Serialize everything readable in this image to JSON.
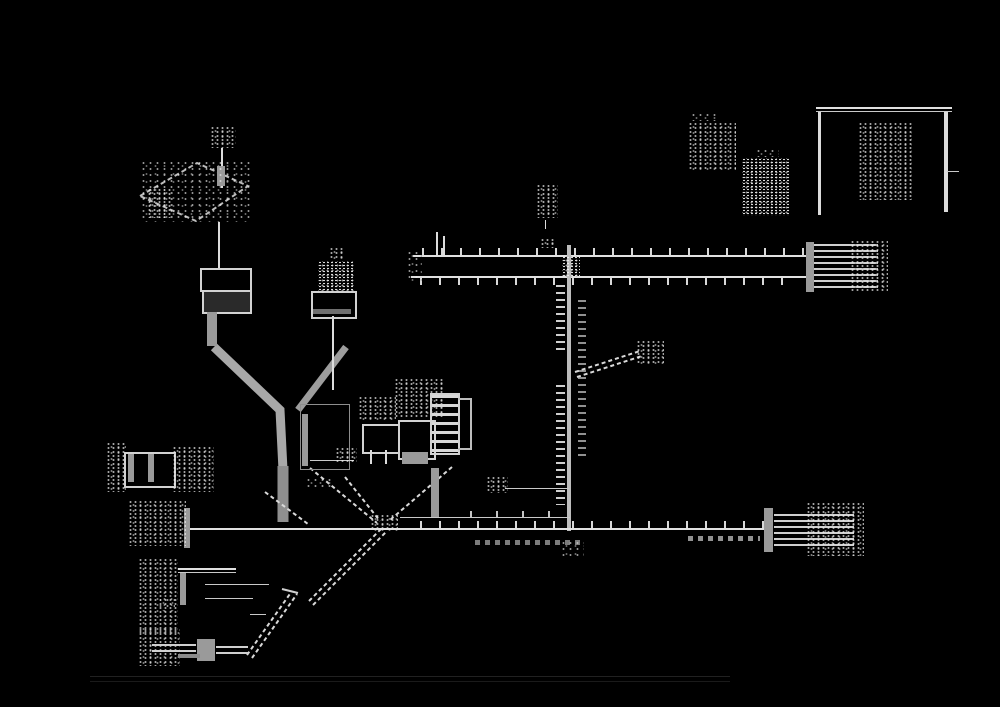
{
  "diagram": {
    "description": "Inverted black-background scan of a vehicle wiring-harness routing diagram; all callout labels are dithered and illegible",
    "background_color": "#000000",
    "line_color": "#e0e0e0",
    "harness_wire_color": "#9a9a9a",
    "baseline_color": "#212121",
    "legible_text": [],
    "components": [
      {
        "name": "isometric-mount-plate",
        "area": "top-left"
      },
      {
        "name": "stacked-unit-cdi",
        "area": "left, below plate"
      },
      {
        "name": "coil-with-bracket",
        "area": "left-center"
      },
      {
        "name": "main-harness-y-junction",
        "area": "center"
      },
      {
        "name": "relay-box-a",
        "area": "center"
      },
      {
        "name": "relay-box-b",
        "area": "center"
      },
      {
        "name": "fuse-ladder",
        "area": "center"
      },
      {
        "name": "twin-wire-top-bus",
        "area": "upper center, x 413-810"
      },
      {
        "name": "battery-block",
        "area": "right end of top bus"
      },
      {
        "name": "vertical-trunk-wire",
        "area": "x 570, y 245-530"
      },
      {
        "name": "branch-connector",
        "area": "right of trunk"
      },
      {
        "name": "long-bottom-harness-line",
        "area": "y 528, x 190-765"
      },
      {
        "name": "end-connector-right",
        "area": "right end of bottom line"
      },
      {
        "name": "switch-symbol-left",
        "area": "left margin"
      },
      {
        "name": "connector-symbol-left-lower",
        "area": "left margin"
      },
      {
        "name": "l-bracket-frame",
        "area": "bottom-left"
      },
      {
        "name": "bottom-left-connector",
        "area": "bottom-left"
      },
      {
        "name": "open-frame-box",
        "area": "top-right"
      },
      {
        "name": "clamp-icon-a",
        "area": "top-right"
      },
      {
        "name": "clamp-icon-b",
        "area": "top-right"
      },
      {
        "name": "ground-baseline",
        "area": "bottom, faint"
      }
    ]
  }
}
